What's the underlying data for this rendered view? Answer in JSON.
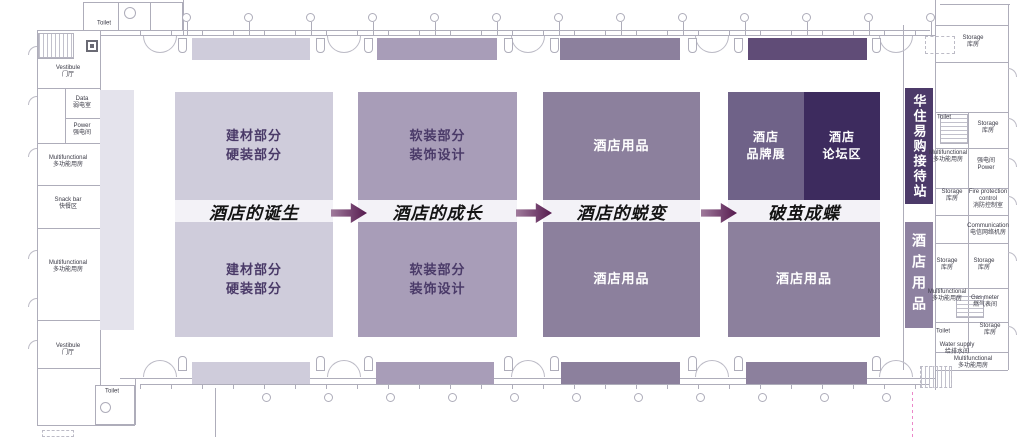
{
  "palette": {
    "zone1": "#cfccdb",
    "zone2": "#a89db8",
    "zone3": "#8c809d",
    "zone4_brand": "#6f6288",
    "zone4_forum": "#3d2b5e",
    "strip4_top": "#604c77",
    "band": "#f3f2f7",
    "arrow_dark": "#551a4e",
    "arrow_light": "#a07b9c",
    "banner_reception": "#4c3a69",
    "banner_supplies": "#8d81a0",
    "left_strip": "#e4e3ec",
    "zone_text_dark": "#4a3a68",
    "plan_line": "#aeadba"
  },
  "hall": {
    "phases": [
      {
        "stage_label": "酒店的诞生",
        "top_zone": "建材部分\n硬装部分",
        "bottom_zone": "建材部分\n硬装部分"
      },
      {
        "stage_label": "酒店的成长",
        "top_zone": "软装部分\n装饰设计",
        "bottom_zone": "软装部分\n装饰设计"
      },
      {
        "stage_label": "酒店的蜕变",
        "top_zone": "酒店用品",
        "bottom_zone": "酒店用品"
      },
      {
        "stage_label": "破茧成蝶",
        "top_zone_left": "酒店\n品牌展",
        "top_zone_right": "酒店\n论坛区",
        "bottom_zone": "酒店用品"
      }
    ]
  },
  "right_banners": {
    "reception": "华住易购接待站",
    "supplies": "酒店用品"
  },
  "left_rooms": [
    {
      "en": "Vestibule",
      "cn": "门厅"
    },
    {
      "en": "Data",
      "cn": "弱电室"
    },
    {
      "en": "Power",
      "cn": "强电间"
    },
    {
      "en": "Multifunctional",
      "cn": "多功能用房"
    },
    {
      "en": "Snack bar",
      "cn": "快餐区"
    },
    {
      "en": "Multifunctional",
      "cn": "多功能用房"
    },
    {
      "en": "Vestibule",
      "cn": "门厅"
    }
  ],
  "right_rooms": [
    {
      "en": "Storage",
      "cn": "库房"
    },
    {
      "en": "Toilet",
      "cn": ""
    },
    {
      "en": "Storage",
      "cn": "库房"
    },
    {
      "en": "Power",
      "cn": "强电间"
    },
    {
      "en": "Fire protection control",
      "cn": "消防控制室"
    },
    {
      "en": "Multifunctional",
      "cn": "多功能用房"
    },
    {
      "en": "Storage",
      "cn": "库房"
    },
    {
      "en": "Communication",
      "cn": "电信网络机房"
    },
    {
      "en": "Storage",
      "cn": "库房"
    },
    {
      "en": "Storage",
      "cn": "库房"
    },
    {
      "en": "Multifunctional",
      "cn": "多功能用房"
    },
    {
      "en": "Gas meter",
      "cn": "燃气表间"
    },
    {
      "en": "Storage",
      "cn": "库房"
    },
    {
      "en": "Toilet",
      "cn": ""
    },
    {
      "en": "Water supply",
      "cn": "给排水间"
    },
    {
      "en": "Multifunctional",
      "cn": "多功能用房"
    }
  ],
  "toilets": {
    "top_left": "Toilet",
    "bottom_left": "Toilet"
  }
}
